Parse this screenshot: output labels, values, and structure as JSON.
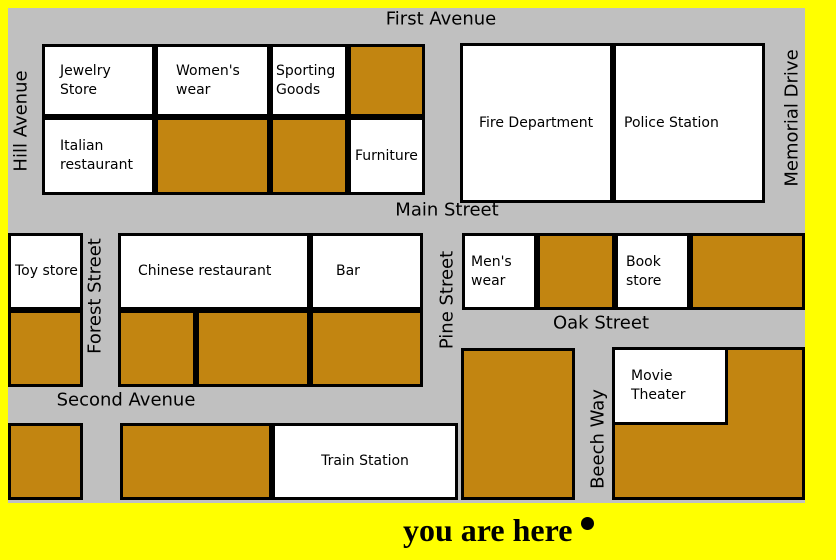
{
  "colors": {
    "background": "#FFFF00",
    "street": "#C0C0C0",
    "unlabeled_building": "#C28511",
    "labeled_building": "#FFFFFF",
    "outline": "#000000",
    "text": "#000000"
  },
  "streets": {
    "first_avenue": "First Avenue",
    "main_street": "Main Street",
    "oak_street": "Oak Street",
    "second_avenue": "Second Avenue",
    "hill_avenue": "Hill Avenue",
    "memorial_drive": "Memorial Drive",
    "forest_street": "Forest Street",
    "pine_street": "Pine Street",
    "beech_way": "Beech Way"
  },
  "buildings": {
    "jewelry_store": "Jewelry Store",
    "womens_wear": "Women's wear",
    "sporting_goods": "Sporting Goods",
    "italian_restaurant": "Italian restaurant",
    "furniture": "Furniture",
    "fire_department": "Fire Department",
    "police_station": "Police Station",
    "toy_store": "Toy store",
    "chinese_restaurant": "Chinese restaurant",
    "bar": "Bar",
    "mens_wear": "Men's wear",
    "book_store": "Book store",
    "movie_theater": "Movie Theater",
    "train_station": "Train Station"
  },
  "marker": {
    "label": "you are here"
  }
}
